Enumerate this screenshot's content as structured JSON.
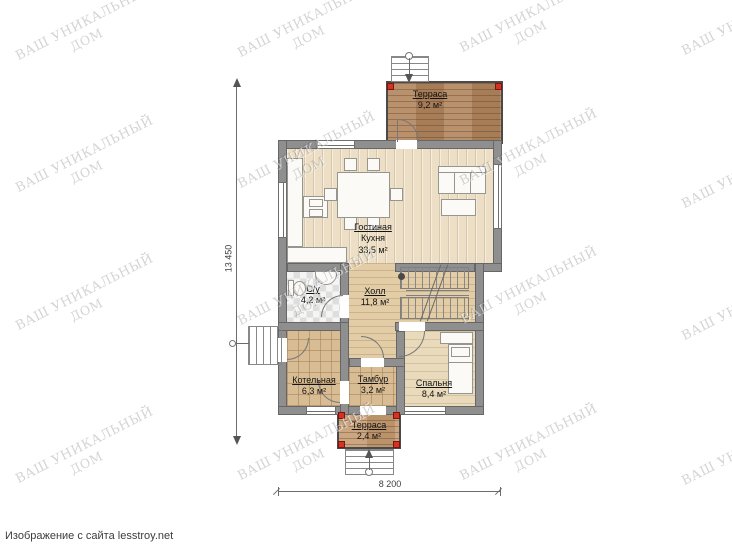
{
  "watermark": {
    "line1": "ВАШ УНИКАЛЬНЫЙ",
    "line2": "ДОМ"
  },
  "caption": "Изображение с сайта lesstroy.net",
  "dimensions": {
    "total_height": "13 450",
    "total_width": "8 200"
  },
  "rooms": {
    "terrace_top": {
      "name": "Терраса",
      "area": "9,2 м²"
    },
    "living": {
      "name": "Гостиная",
      "name2": "Кухня",
      "area": "33,5 м²"
    },
    "bathroom": {
      "name": "С/у",
      "area": "4,2 м²"
    },
    "hall": {
      "name": "Холл",
      "area": "11,8 м²"
    },
    "boiler": {
      "name": "Котельная",
      "area": "6,3 м²"
    },
    "vestibule": {
      "name": "Тамбур",
      "area": "3,2 м²"
    },
    "bedroom": {
      "name": "Спальня",
      "area": "8,4 м²"
    },
    "terrace_bottom": {
      "name": "Терраса",
      "area": "2,4 м²"
    }
  }
}
